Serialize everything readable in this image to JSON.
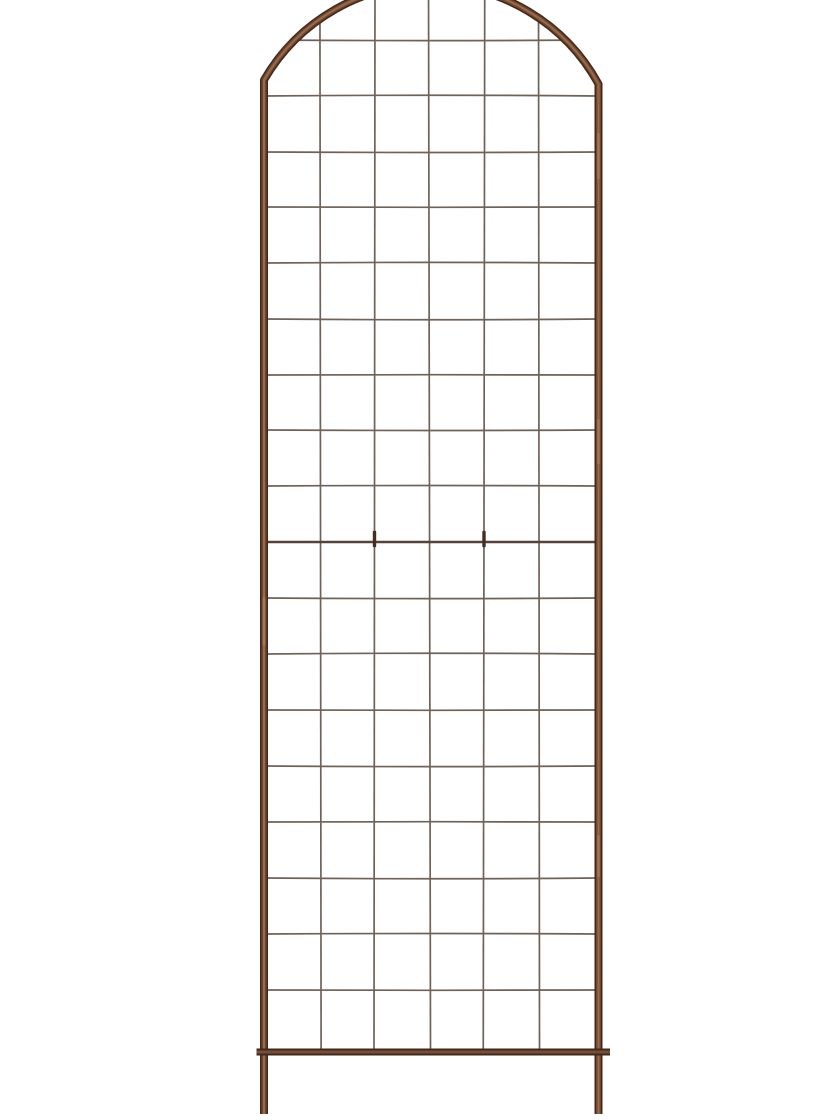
{
  "scene": {
    "width": 840,
    "height": 1120,
    "background": "#ffffff",
    "description": "Product photo of a tall arched metal garden trellis with a square wire grid, rust-brown copper finish, bottom cross bar and two ground stake legs, on a plain white background"
  },
  "trellis": {
    "colors": {
      "frame_edge": "#43291d",
      "frame_mid": "#6e452f",
      "frame_highlight": "#966a48",
      "copper_streak": "#a87c55",
      "bar_edge": "#3c281d",
      "bar_mid": "#5e3c2a",
      "bar_highlight": "#7b5138",
      "wire": "#6f6258",
      "seam_wire": "#55433a",
      "clip": "#472f1f"
    },
    "frame": {
      "left_x": 264,
      "right_x": 598.5,
      "bend_y_left": 80,
      "bend_y_right": 84,
      "arch_radius": 192,
      "leg_bottom_y": 1114,
      "tube_width_outer": 8,
      "tube_width_mid": 5,
      "tube_width_highlight": 2.2
    },
    "bottom_bar": {
      "y": 1052,
      "x1": 256.5,
      "x2": 610,
      "width_outer": 7,
      "width_mid": 4.2,
      "width_highlight": 1.8
    },
    "grid": {
      "columns": 6,
      "wire_width": 1.7,
      "seam_wire_width": 2.6,
      "vertical_wires": [
        {
          "x": 320.5,
          "tilt": 1.2
        },
        {
          "x": 374.5,
          "tilt": -1.0
        },
        {
          "x": 429.5,
          "tilt": 2.0
        },
        {
          "x": 484.0,
          "tilt": -1.5
        },
        {
          "x": 539.0,
          "tilt": 1.0
        }
      ],
      "horizontal_wires_y": [
        40,
        96,
        152,
        207,
        263,
        319,
        375,
        430,
        486,
        542,
        598,
        654,
        710,
        766,
        822,
        878,
        934,
        990
      ],
      "horizontal_bows": [
        1.2,
        -1.5,
        1.0,
        0.6,
        -1.2,
        1.5,
        -0.6,
        1.0,
        -1.0,
        0.0,
        1.2,
        -1.5,
        0.6,
        1.2,
        -0.6,
        1.5,
        -1.0,
        0.6
      ],
      "seam_y": 542,
      "clip_xs": [
        374.5,
        484.0
      ],
      "clip_height": 16.5,
      "clip_width": 3.4
    },
    "streaks": [
      {
        "x": 598.5,
        "y1": 134,
        "y2": 178
      },
      {
        "x": 598.5,
        "y1": 420,
        "y2": 463
      },
      {
        "x": 598.5,
        "y1": 836,
        "y2": 876
      },
      {
        "x": 264.0,
        "y1": 598,
        "y2": 644
      }
    ]
  }
}
